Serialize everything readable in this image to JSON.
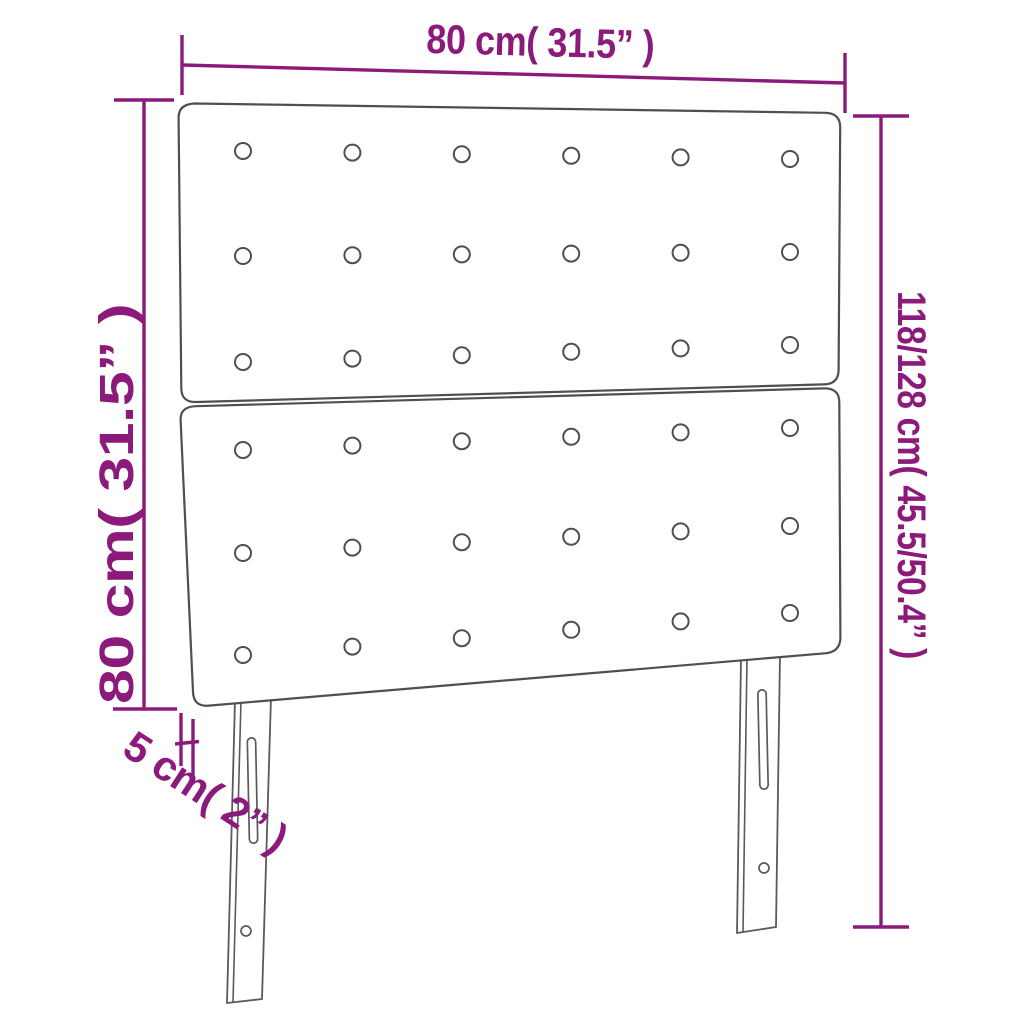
{
  "page": {
    "title": "Headboard dimension diagram",
    "background": "#ffffff"
  },
  "dimensions": {
    "width_label": "80 cm( 31.5” )",
    "total_height_label": "118/128 cm( 45.5/50.4” )",
    "board_height_label": "80 cm( 31.5” )",
    "thickness_label": "5 cm( 2” )"
  },
  "colors": {
    "dimension_accent": "#8b1a7b",
    "drawing_outline": "#4f4f4f",
    "background": "#ffffff"
  },
  "figure": {
    "panels": 2,
    "tuft_rows_per_panel": 3,
    "tuft_columns": 6,
    "legs": 2,
    "leg_slots_per_leg": 1,
    "leg_holes_per_leg": 1
  }
}
